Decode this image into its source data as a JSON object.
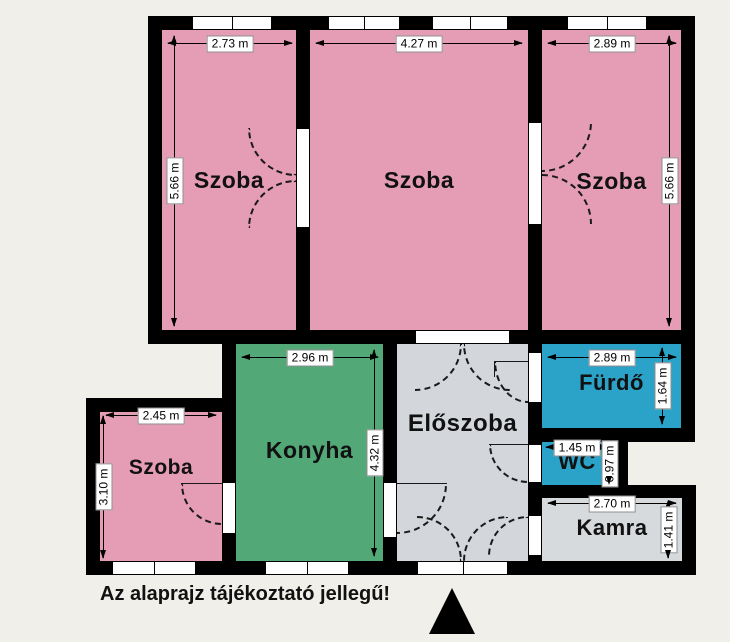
{
  "plan": {
    "background_color": "#f0efe9",
    "wall_color": "#000000",
    "disclaimer": "Az alaprajz tájékoztató jellegű!",
    "north_arrow": "black-up-triangle"
  },
  "rooms": [
    {
      "id": "szoba-top-left",
      "label": "Szoba",
      "color": "#e59cb5",
      "width_dim": "2.73 m",
      "height_dim": "5.66 m"
    },
    {
      "id": "szoba-top-middle",
      "label": "Szoba",
      "color": "#e59cb5",
      "width_dim": "4.27 m"
    },
    {
      "id": "szoba-top-right",
      "label": "Szoba",
      "color": "#e59cb5",
      "width_dim": "2.89 m",
      "height_dim": "5.66 m"
    },
    {
      "id": "konyha",
      "label": "Konyha",
      "color": "#53a878",
      "width_dim": "2.96 m",
      "height_dim": "4.32 m"
    },
    {
      "id": "eloszoba",
      "label": "Előszoba",
      "color": "#d3d6da"
    },
    {
      "id": "furdo",
      "label": "Fürdő",
      "color": "#2ba2c8",
      "width_dim": "2.89 m",
      "height_dim": "1.64 m"
    },
    {
      "id": "wc",
      "label": "WC",
      "color": "#2ba2c8",
      "width_dim": "1.45 m",
      "height_dim": "0.97 m"
    },
    {
      "id": "kamra",
      "label": "Kamra",
      "color": "#d7dadd",
      "width_dim": "2.70 m",
      "height_dim": "1.41 m"
    },
    {
      "id": "szoba-bottom-left",
      "label": "Szoba",
      "color": "#e59cb5",
      "width_dim": "2.45 m",
      "height_dim": "3.10 m"
    }
  ]
}
